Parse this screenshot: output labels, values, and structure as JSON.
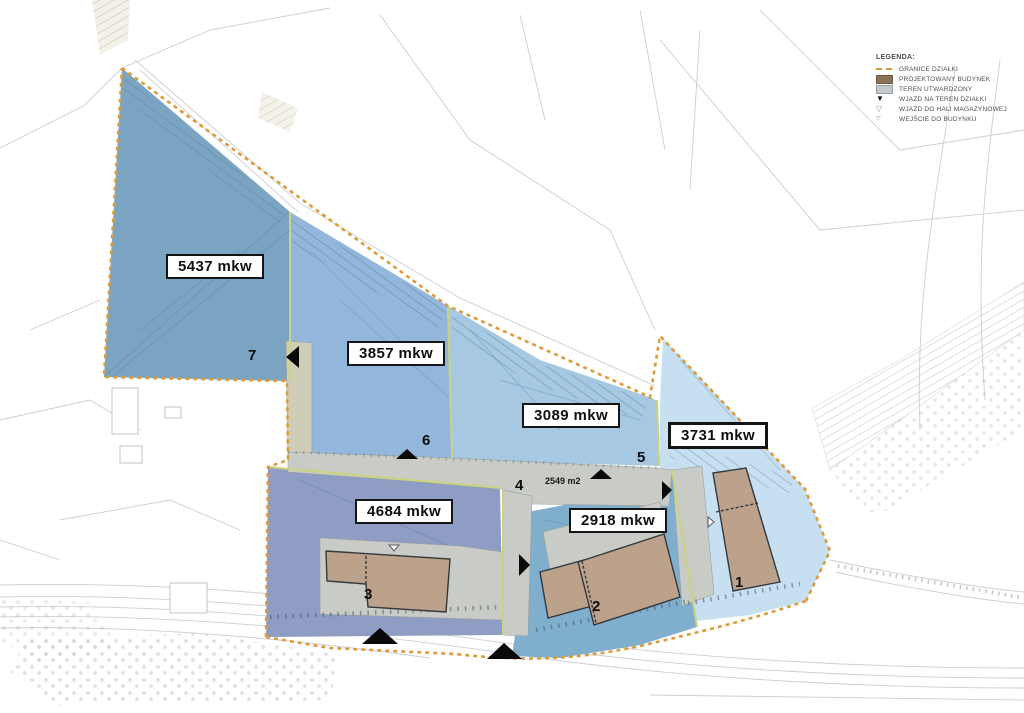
{
  "map": {
    "title": "site development plan",
    "unit_note": "mkw"
  },
  "parcels": [
    {
      "number": "7",
      "area": "5437 mkw"
    },
    {
      "number": "6",
      "area": "3857 mkw"
    },
    {
      "number": "5",
      "area": "3089 mkw"
    },
    {
      "number": "4",
      "area": "2549 m2"
    },
    {
      "number": "3",
      "area": "4684 mkw"
    },
    {
      "number": "2",
      "area": "2918 mkw"
    },
    {
      "number": "1",
      "area": "3731 mkw"
    }
  ],
  "legend": {
    "title": "LEGENDA:",
    "items": [
      {
        "label": "GRANICE DZIAŁKI",
        "icon": "dashed-line-swatch"
      },
      {
        "label": "PROJEKTOWANY BUDYNEK",
        "icon": "building-swatch"
      },
      {
        "label": "TEREN UTWARDZONY",
        "icon": "paved-swatch"
      },
      {
        "label": "WJAZD NA TEREN DZIAŁKI",
        "icon": "black-triangle-icon"
      },
      {
        "label": "WJAZD DO HALI MAGAZYNOWEJ",
        "icon": "outline-triangle-icon"
      },
      {
        "label": "WEJŚCIE DO BUDYNKU",
        "icon": "entrance-triangle-icon"
      }
    ]
  },
  "colors": {
    "parcel7": "#7ba4c2",
    "parcel6": "#93b7dc",
    "parcel5": "#a6c8e2",
    "parcel1": "#c7e0f1",
    "parcel3": "#8f9cc3",
    "parcel2": "#80aecd",
    "building": "#bda28b",
    "paved": "#c9ccc6",
    "paved_beige": "#cfccb8",
    "boundary": "#dd9c3c",
    "sub_boundary": "#cad37d"
  }
}
